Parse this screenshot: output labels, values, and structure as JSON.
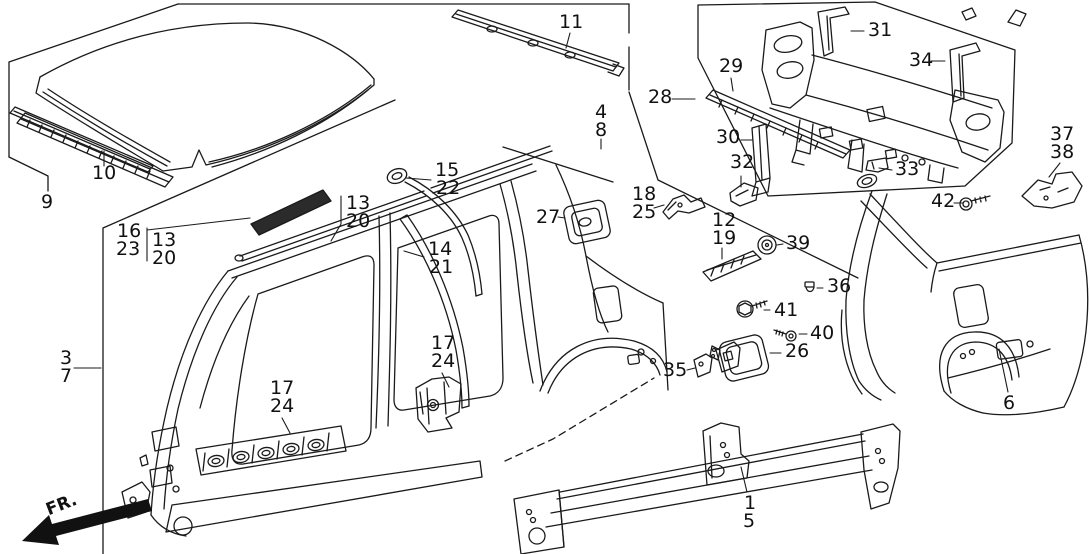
{
  "diagram": {
    "type": "exploded-parts-diagram",
    "subject": "vehicle body outer panels line drawing",
    "background_color": "#ffffff",
    "line_color": "#1a1a1a",
    "direction_indicator": "FR.",
    "callouts": {
      "n1": "1",
      "n2_6": "6",
      "n3": "3",
      "n4": "4",
      "n5": "5",
      "n7": "7",
      "n8": "8",
      "n9": "9",
      "n10": "10",
      "n11": "11",
      "n12": "12",
      "n13a": "13",
      "n13b": "13",
      "n14": "14",
      "n15": "15",
      "n16": "16",
      "n17a": "17",
      "n17b": "17",
      "n18": "18",
      "n19": "19",
      "n20a": "20",
      "n20b": "20",
      "n21": "21",
      "n22": "22",
      "n23": "23",
      "n24a": "24",
      "n24b": "24",
      "n25": "25",
      "n26": "26",
      "n27": "27",
      "n28": "28",
      "n29": "29",
      "n30": "30",
      "n31": "31",
      "n32": "32",
      "n33": "33",
      "n34": "34",
      "n35": "35",
      "n36": "36",
      "n37": "37",
      "n38": "38",
      "n39": "39",
      "n40": "40",
      "n41": "41",
      "n42": "42"
    }
  }
}
